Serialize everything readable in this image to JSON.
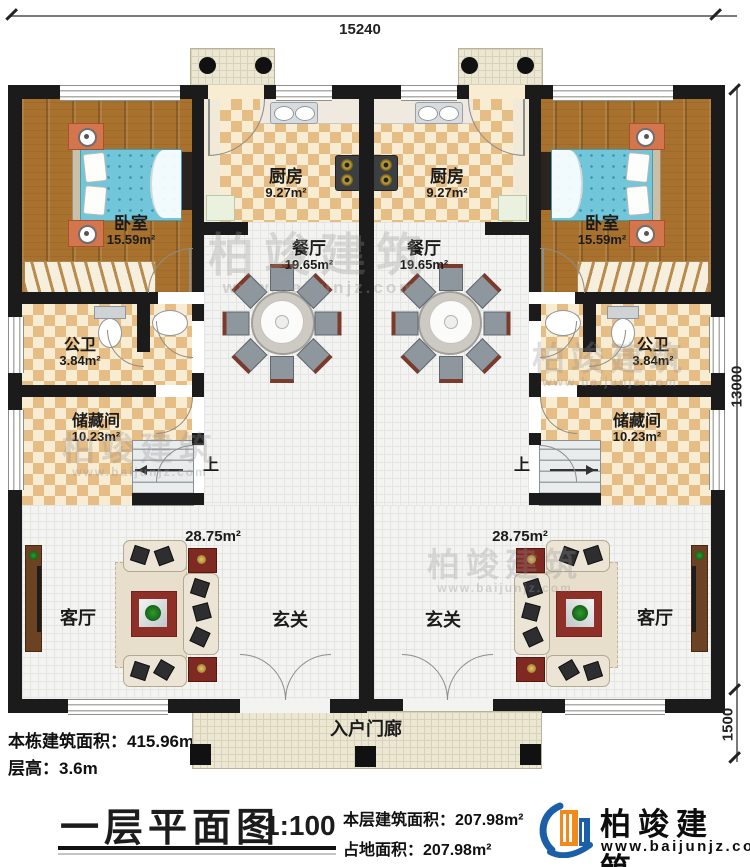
{
  "title": "一层平面图",
  "scale": "1:100",
  "dimensions": {
    "width_top": "15240",
    "height_right": "13000",
    "porch_depth": "1500"
  },
  "rooms": {
    "bedroom": {
      "name": "卧室",
      "area": "15.59m²"
    },
    "kitchen": {
      "name": "厨房",
      "area": "9.27m²"
    },
    "dining": {
      "name": "餐厅",
      "area": "19.65m²"
    },
    "bathroom": {
      "name": "公卫",
      "area": "3.84m²"
    },
    "storage": {
      "name": "储藏间",
      "area": "10.23m²"
    },
    "living": {
      "name": "客厅",
      "area": "28.75m²"
    },
    "foyer": {
      "name": "玄关"
    },
    "entry_porch": {
      "name": "入户门廊"
    },
    "stairs": {
      "up_label": "上"
    }
  },
  "notes": {
    "building_area_label": "本栋建筑面积：",
    "building_area_value": "415.96m²",
    "floor_height_label": "层高：",
    "floor_height_value": "3.6m",
    "floor_area_label": "本层建筑面积：",
    "floor_area_value": "207.98m²",
    "ground_area_label": "占地面积：",
    "ground_area_value": "207.98m²"
  },
  "brand": {
    "name": "柏竣建筑",
    "website": "www.baijunjz.com"
  },
  "watermark": {
    "name": "柏竣建筑",
    "website": "www.baijunjz.com"
  },
  "colors": {
    "wall": "#1b1b1b",
    "wood": "#a8722e",
    "checker": "#e5bd85",
    "tile": "#f3f3f1",
    "bed": "#72c6d9",
    "rug": "#8f3028",
    "brand_blue": "#1a5fa8",
    "brand_orange": "#f28a1b"
  }
}
